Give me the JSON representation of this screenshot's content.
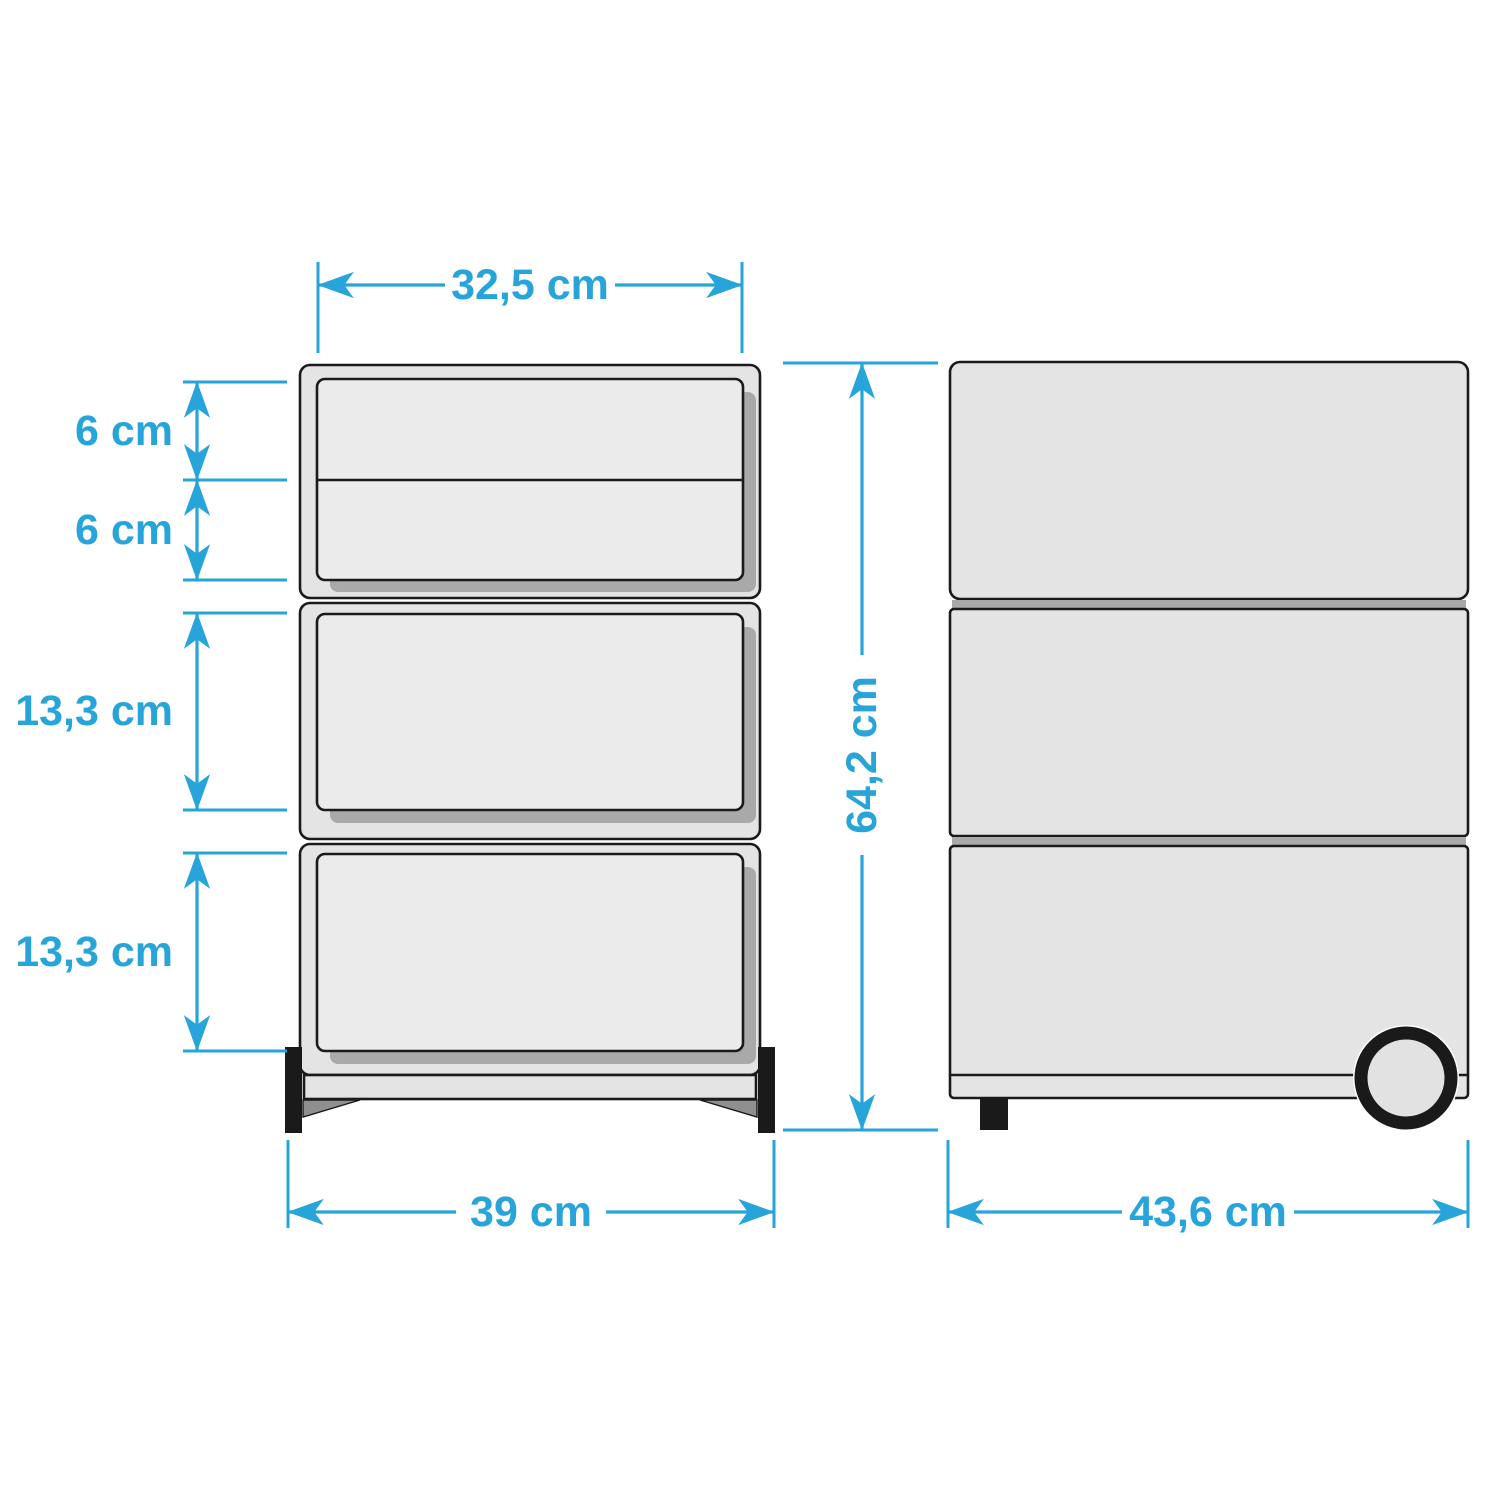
{
  "diagram": {
    "title": "Drawer pedestal dimension diagram",
    "unit": "cm",
    "views": {
      "front": {
        "label": "front-view",
        "drawer_count": 4,
        "dimensions": {
          "top_inner_width": "32,5 cm",
          "small_drawer_1_height": "6 cm",
          "small_drawer_2_height": "6 cm",
          "large_drawer_1_height": "13,3 cm",
          "large_drawer_2_height": "13,3 cm",
          "base_width": "39 cm"
        }
      },
      "side": {
        "label": "side-view",
        "panel_count": 3,
        "dimensions": {
          "total_height": "64,2 cm",
          "depth": "43,6 cm"
        }
      }
    }
  },
  "colors": {
    "dimension": "#27A4DA",
    "body": "#E4E4E4",
    "drawer_face": "#EBEBEB",
    "shadow": "#A9A9A9",
    "outline": "#1A1A1A",
    "wedge": "#8F8F8F",
    "wheel_fill": "#E2E2E2",
    "background": "#FFFFFF"
  }
}
